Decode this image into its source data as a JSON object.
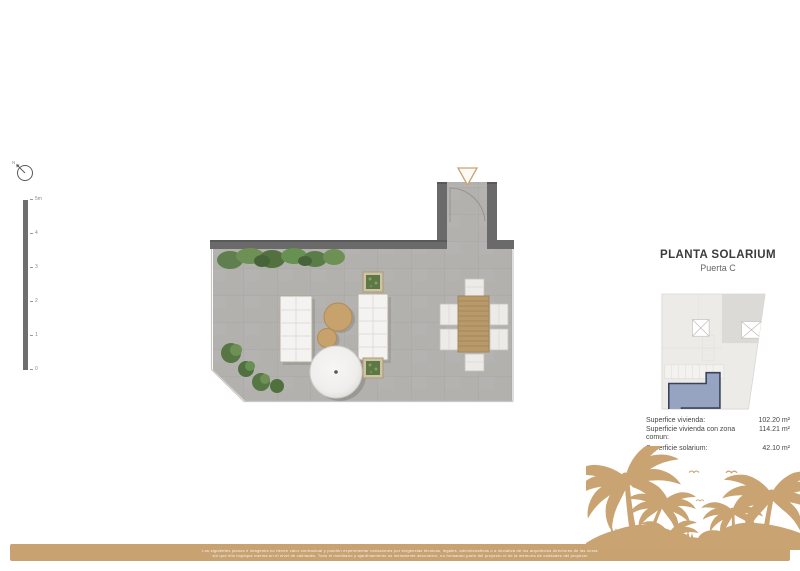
{
  "compass": {
    "label": "N"
  },
  "scale_bar": {
    "ticks": [
      "5m",
      "4",
      "3",
      "2",
      "1",
      "0"
    ]
  },
  "panel": {
    "title": "PLANTA SOLARIUM",
    "subtitle": "Puerta C",
    "areas": [
      {
        "label": "Superfice vivienda:",
        "value": "102.20 m²"
      },
      {
        "label": "Superficie vivienda con zona comun:",
        "value": "114.21 m²"
      },
      {
        "label": "Superficie solarium:",
        "value": "42.10 m²"
      }
    ]
  },
  "footer": {
    "line1": "Los siguientes planos e imágenes no tienen valor contractual y pueden experimentar variaciones por exigencias técnicas, legales, administrativas o a iniciativa de los arquitectos directores de las obras",
    "line2": "sin que ello implique merma en el nivel de calidades. Todo el mobiliario y ajardinamiento es meramente decorativo, no formando parte del proyecto ni de la memoria de calidades del proyecto"
  },
  "colors": {
    "accent_gold": "#c8a271",
    "wall_gray": "#6a6a6a",
    "floor_gray": "#b3b1ae",
    "highlight_unit_fill": "#91a0c0",
    "highlight_unit_border": "#39425a",
    "plant_green": "#5f7f4e"
  }
}
